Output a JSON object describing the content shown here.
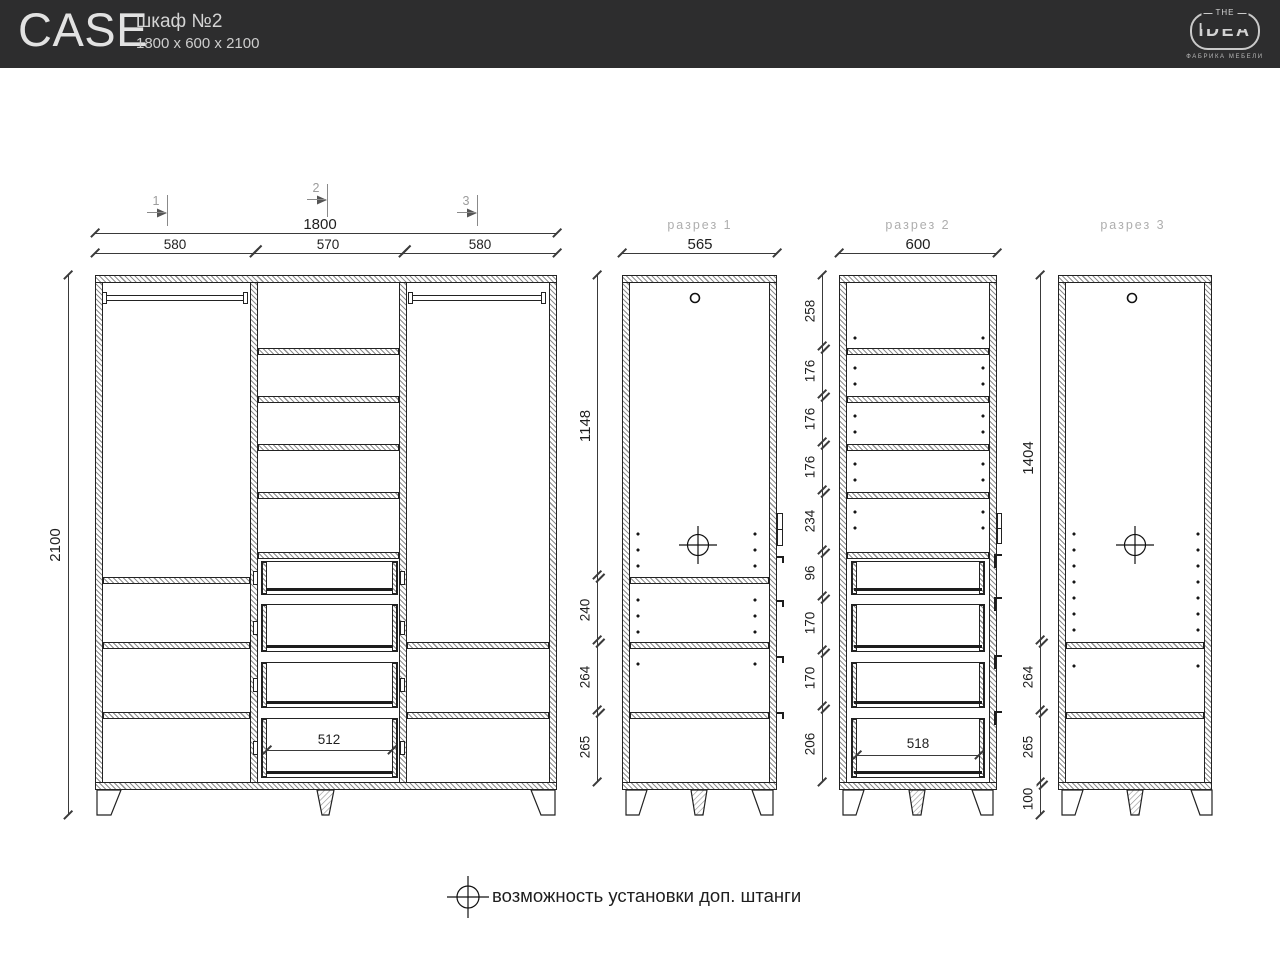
{
  "header": {
    "brand": "CASE",
    "product_name": "шкаф №2",
    "product_size": "1800 x 600 x 2100",
    "logo": {
      "top": "THE",
      "main": "IDEA",
      "subtitle": "ФАБРИКА МЕБЕЛИ"
    }
  },
  "front_view": {
    "section_markers": [
      "1",
      "2",
      "3"
    ],
    "width_total": "1800",
    "column_widths": [
      "580",
      "570",
      "580"
    ],
    "height_total": "2100",
    "drawer_width": "512"
  },
  "section_1": {
    "title": "разрез 1",
    "width": "565",
    "heights": [
      "1148",
      "240",
      "264",
      "265"
    ]
  },
  "section_2": {
    "title": "разрез 2",
    "width": "600",
    "heights": [
      "258",
      "176",
      "176",
      "176",
      "234",
      "96",
      "170",
      "170",
      "206"
    ],
    "drawer_width": "518"
  },
  "section_3": {
    "title": "разрез 3",
    "heights": [
      "1404",
      "264",
      "265",
      "100"
    ]
  },
  "legend": {
    "note": "возможность установки доп. штанги"
  }
}
